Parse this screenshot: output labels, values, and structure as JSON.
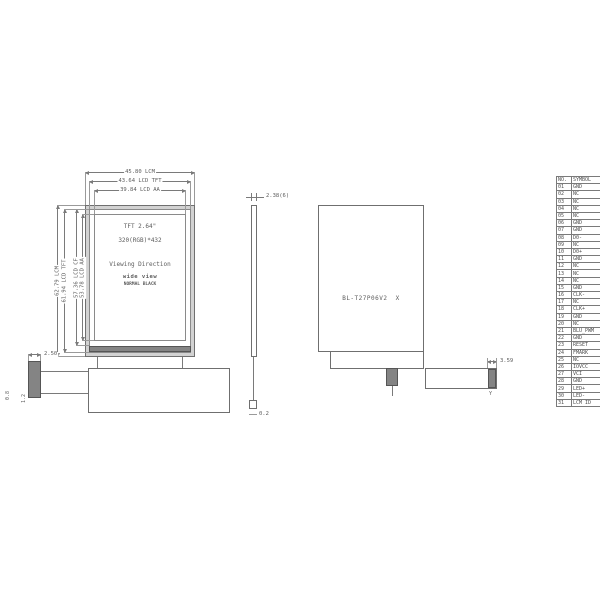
{
  "front": {
    "dims_top": [
      "45.80 LCM",
      "43.64 LCD TFT",
      "39.84 LCD AA"
    ],
    "dims_left": [
      "62.79 LCM",
      "61.94 LCD TFT",
      "57.36 LCD CF",
      "53.78 LCD AA"
    ],
    "panel": {
      "size": "TFT 2.64\"",
      "resolution": "320(RGB)*432",
      "viewing": "Viewing Direction",
      "view_type": "wide view",
      "mode": "NORMAL BLACK"
    }
  },
  "side": {
    "thickness": "2.38(6)",
    "fpc_thickness": "0.2"
  },
  "back": {
    "model": "BL-T27P06V2  X"
  },
  "fpc": {
    "connector_width": "2.50",
    "dim_a": "0.8",
    "dim_b": "1.2",
    "stiffener_width": "3.59",
    "mark": "Y"
  },
  "pin_table": {
    "headers": {
      "no": "NO.",
      "symbol": "SYMBOL"
    },
    "rows": [
      {
        "no": "01",
        "symbol": "GND"
      },
      {
        "no": "02",
        "symbol": "NC"
      },
      {
        "no": "03",
        "symbol": "NC"
      },
      {
        "no": "04",
        "symbol": "NC"
      },
      {
        "no": "05",
        "symbol": "NC"
      },
      {
        "no": "06",
        "symbol": "GND"
      },
      {
        "no": "07",
        "symbol": "GND"
      },
      {
        "no": "08",
        "symbol": "D0-"
      },
      {
        "no": "09",
        "symbol": "NC"
      },
      {
        "no": "10",
        "symbol": "D0+"
      },
      {
        "no": "11",
        "symbol": "GND"
      },
      {
        "no": "12",
        "symbol": "NC"
      },
      {
        "no": "13",
        "symbol": "NC"
      },
      {
        "no": "14",
        "symbol": "NC"
      },
      {
        "no": "15",
        "symbol": "GND"
      },
      {
        "no": "16",
        "symbol": "CLK-"
      },
      {
        "no": "17",
        "symbol": "NC"
      },
      {
        "no": "18",
        "symbol": "CLK+"
      },
      {
        "no": "19",
        "symbol": "GND"
      },
      {
        "no": "20",
        "symbol": "NC"
      },
      {
        "no": "21",
        "symbol": "BLU_PWM"
      },
      {
        "no": "22",
        "symbol": "GND"
      },
      {
        "no": "23",
        "symbol": "RESET"
      },
      {
        "no": "24",
        "symbol": "FMARK"
      },
      {
        "no": "25",
        "symbol": "NC"
      },
      {
        "no": "26",
        "symbol": "IOVCC"
      },
      {
        "no": "27",
        "symbol": "VCI"
      },
      {
        "no": "28",
        "symbol": "GND"
      },
      {
        "no": "29",
        "symbol": "LED+"
      },
      {
        "no": "30",
        "symbol": "LED-"
      },
      {
        "no": "31",
        "symbol": "LCM ID"
      }
    ]
  },
  "colors": {
    "line": "#7a7a7a",
    "text": "#5c5c5c",
    "background": "#ffffff"
  }
}
